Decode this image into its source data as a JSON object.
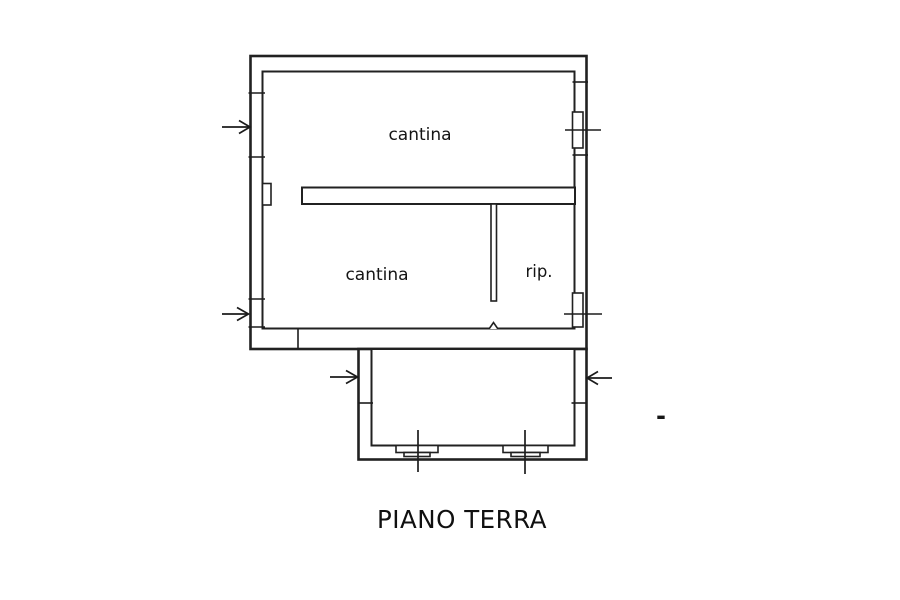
{
  "plan": {
    "title": "PIANO TERRA",
    "rooms": [
      {
        "name": "cantina-upper",
        "label": "cantina"
      },
      {
        "name": "cantina-lower",
        "label": "cantina"
      },
      {
        "name": "ripostiglio",
        "label": "rip."
      }
    ],
    "dash_mark": "-"
  },
  "colors": {
    "ink": "#212121",
    "paper": "#ffffff",
    "text": "#141414"
  }
}
